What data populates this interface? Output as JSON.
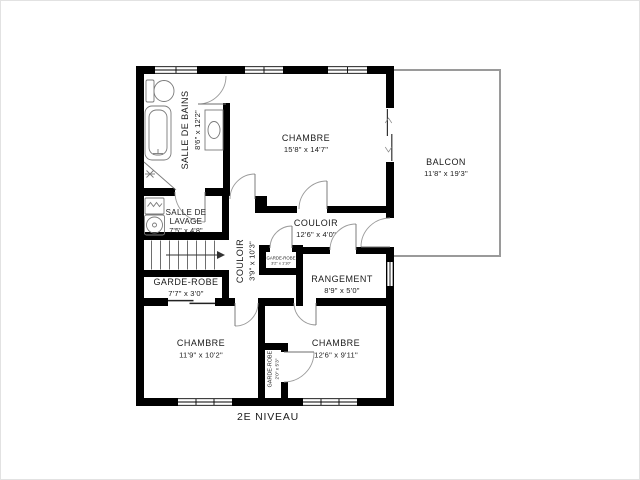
{
  "title": "2E NIVEAU",
  "colors": {
    "wall": "#000000",
    "door_arc": "#9a9a9a",
    "balcony_outline": "#9a9a9a",
    "fixture_outline": "#7a7a7a",
    "text": "#1b1b1b",
    "background": "#ffffff"
  },
  "rooms": {
    "salle_de_bains": {
      "name": "SALLE DE BAINS",
      "dims": "8'6\" x 12'2\""
    },
    "chambre_1": {
      "name": "CHAMBRE",
      "dims": "15'8\" x 14'7\""
    },
    "balcon": {
      "name": "BALCON",
      "dims": "11'8\" x 19'3\""
    },
    "salle_de_lavage": {
      "name_lines": [
        "SALLE DE",
        "LAVAGE"
      ],
      "dims": "7'5\" x 4'8\""
    },
    "couloir_vertical": {
      "name": "COULOIR",
      "dims": "3'9\" x 10'3\""
    },
    "couloir_horizontal": {
      "name": "COULOIR",
      "dims": "12'6\" x 4'0\""
    },
    "garde_robe_couloir": {
      "name": "GARDE-ROBE",
      "dims": "3'2\" x 1'10\""
    },
    "garde_robe_principal": {
      "name": "GARDE-ROBE",
      "dims": "7'7\" x 3'0\""
    },
    "rangement": {
      "name": "RANGEMENT",
      "dims": "8'9\" x 5'0\""
    },
    "chambre_2": {
      "name": "CHAMBRE",
      "dims": "11'9\" x 10'2\""
    },
    "chambre_3": {
      "name": "CHAMBRE",
      "dims": "12'6\" x 9'11\""
    },
    "garde_robe_chambre": {
      "name": "GARDE-ROBE",
      "dims": "2'0\" x 5'3\""
    }
  }
}
